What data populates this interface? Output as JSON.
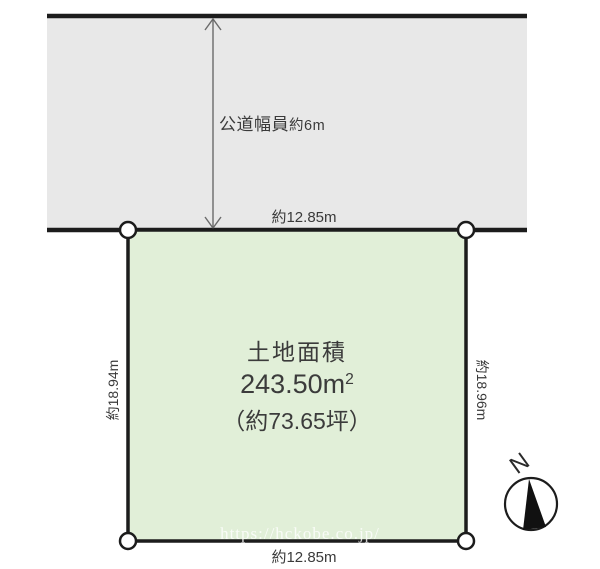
{
  "colors": {
    "background": "#ffffff",
    "road_fill": "#e8e8e8",
    "plot_fill": "#e1efd8",
    "line": "#1c1c1c",
    "text": "#3a3a3a",
    "arrow": "#6b6b6b",
    "watermark": "rgba(255,255,255,0.8)"
  },
  "road": {
    "label": "公道幅員",
    "width_value": "約6m",
    "frontage_dimension": "約12.85m"
  },
  "plot": {
    "area_title": "土地面積",
    "area_value": "243.50m",
    "area_value_sup": "2",
    "area_tsubo": "（約73.65坪）",
    "left_dimension": "約18.94m",
    "right_dimension": "約18.96m",
    "bottom_dimension": "約12.85m"
  },
  "compass": {
    "north_label": "N"
  },
  "watermark": {
    "text": "https://hckobe.co.jp/"
  }
}
